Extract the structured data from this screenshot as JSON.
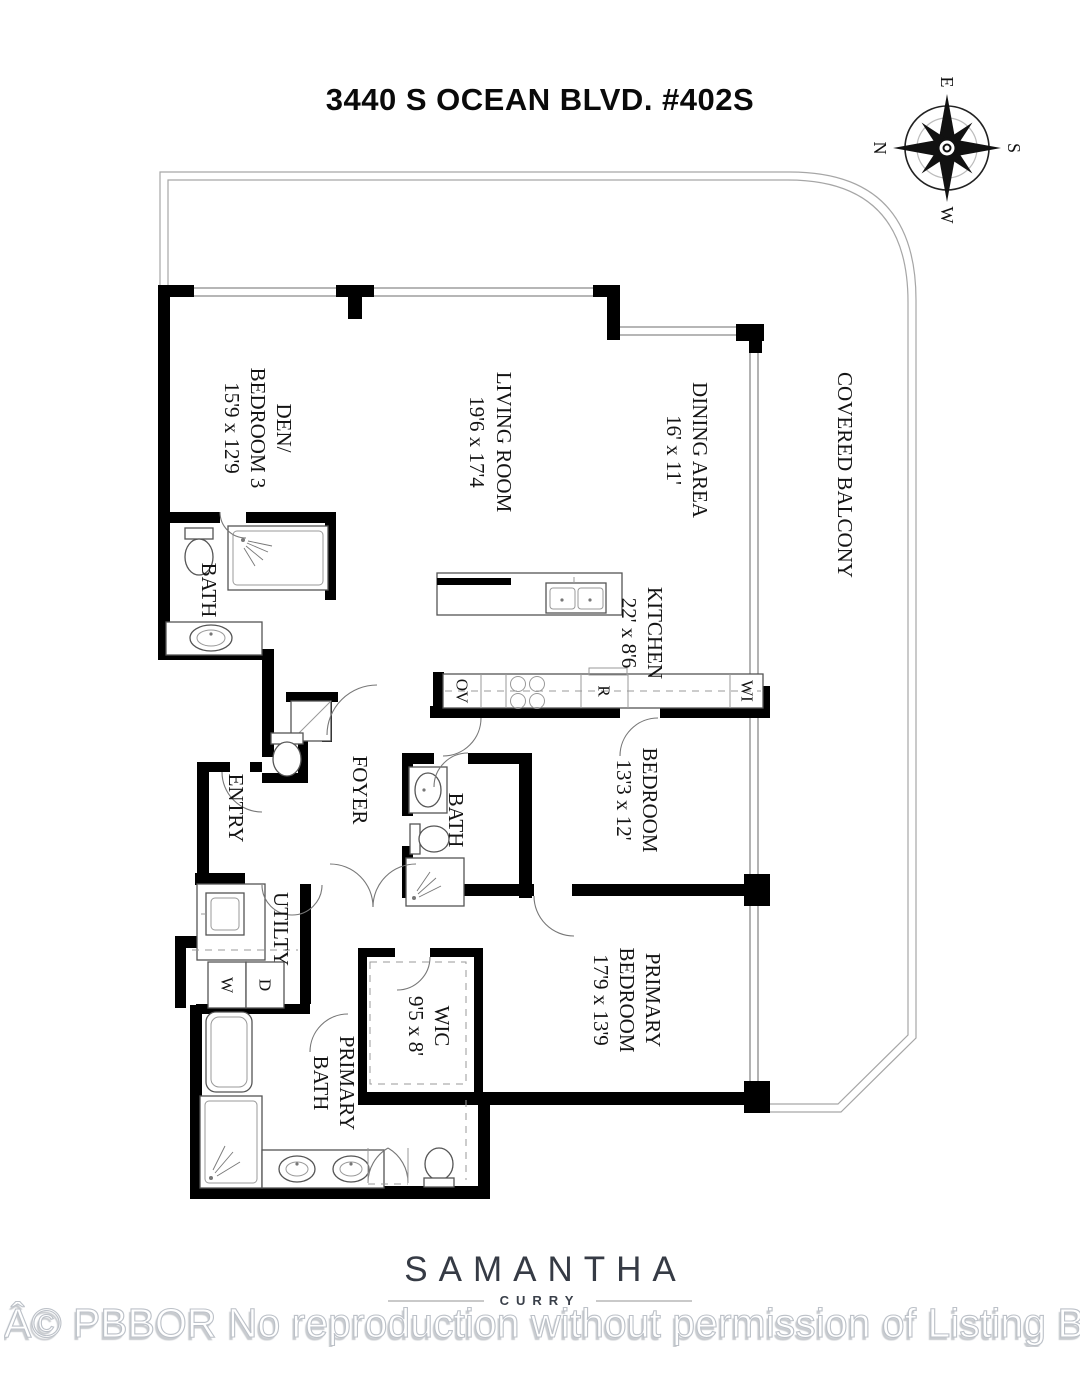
{
  "title": "3440 S OCEAN BLVD. #402S",
  "compass": {
    "n": "N",
    "e": "E",
    "s": "S",
    "w": "W"
  },
  "rooms": {
    "den": {
      "name1": "DEN/",
      "name2": "BEDROOM 3",
      "dims": "15'9 x 12'9"
    },
    "living": {
      "name": "LIVING ROOM",
      "dims": "19'6 x 17'4"
    },
    "dining": {
      "name": "DINING AREA",
      "dims": "16' x 11'"
    },
    "balcony": {
      "name": "COVERED BALCONY"
    },
    "bath1": {
      "name": "BATH"
    },
    "kitchen": {
      "name": "KITCHEN",
      "dims": "22' x 8'6"
    },
    "entry": {
      "name": "ENTRY"
    },
    "foyer": {
      "name": "FOYER"
    },
    "bath2": {
      "name": "BATH"
    },
    "bedroom2": {
      "name": "BEDROOM",
      "dims": "13'3 x 12'"
    },
    "utility": {
      "name": "UTILTY"
    },
    "wic": {
      "name": "WIC",
      "dims": "9'5 x 8'"
    },
    "primary_bath": {
      "name1": "PRIMARY",
      "name2": "BATH"
    },
    "primary_bedroom": {
      "name1": "PRIMARY",
      "name2": "BEDROOM",
      "dims": "17'9 x 13'9"
    }
  },
  "appliances": {
    "oven": "OV",
    "range_fridge": "R",
    "wine": "WI",
    "washer": "W",
    "dryer": "D"
  },
  "logo": {
    "first_name": "SAMANTHA",
    "last_name": "CURRY"
  },
  "watermark": "Â© PBBOR No reproduction without permission of Listing Brok",
  "colors": {
    "wall": "#000000",
    "thin_line": "#8a8a8a",
    "logo_text": "#363b45",
    "watermark_stroke": "#bcc1c8"
  }
}
